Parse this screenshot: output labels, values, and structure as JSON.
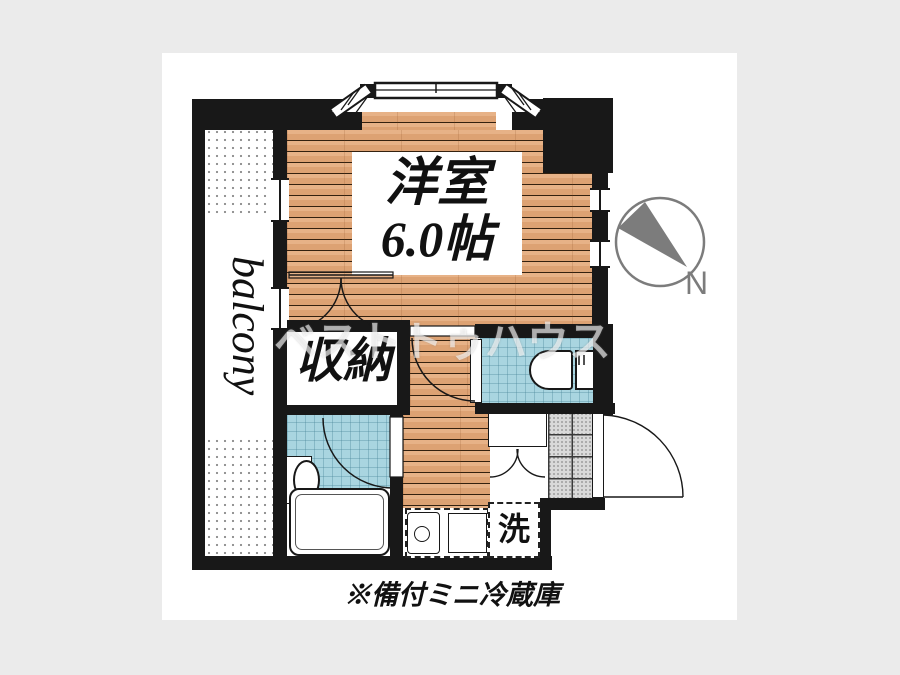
{
  "plan": {
    "note": "※備付ミニ冷蔵庫",
    "watermark": "ベストトゥハウス",
    "rooms": {
      "main_room": {
        "name": "洋室",
        "size": "6.0帖"
      },
      "closet": {
        "label": "収納"
      },
      "balcony": {
        "label": "balcony"
      },
      "washer_space": {
        "label": "洗"
      }
    },
    "compass": {
      "label": "N"
    },
    "colors": {
      "page_background": "#ebebeb",
      "canvas": "#ffffff",
      "wall": "#181818",
      "wood_floor": "#dfa57a",
      "wet_room_tile": "#a9d5e0",
      "entrance_tile": "#d9d9d9",
      "compass_gray": "#808080"
    }
  }
}
